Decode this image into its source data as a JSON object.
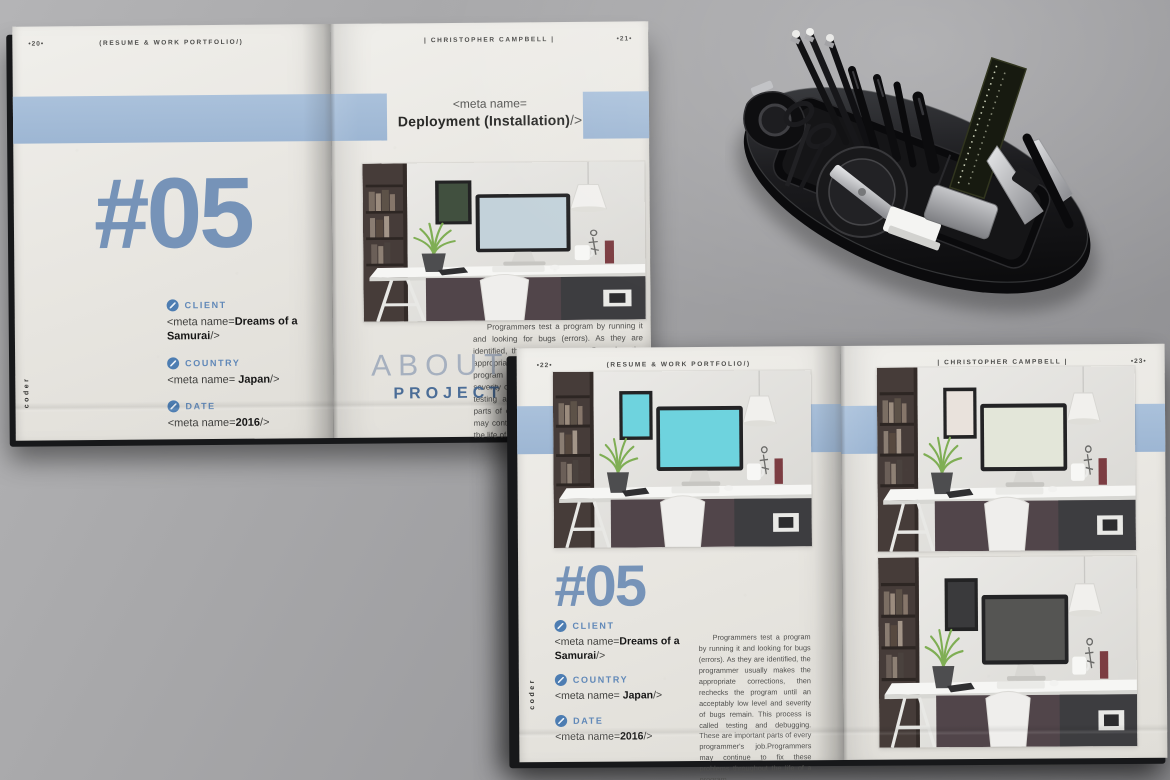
{
  "colors": {
    "background_gray": "#9a9a9d",
    "page": "#eceae5",
    "band_blue": "#a3bbd7",
    "number_blue": "#7693b8",
    "label_blue": "#6088b8",
    "title_blue": "#4b6d97",
    "teal_screen": "#6ed3de",
    "organizer_black": "#121214"
  },
  "top_spread": {
    "left_page": {
      "page_number": "•20•",
      "header": "(RESUME & WORK PORTFOLIO/)",
      "issue_number": "#05",
      "spine_text": "coder",
      "fields": [
        {
          "icon": "pencil-icon",
          "label": "CLIENT",
          "prefix": "<meta name=",
          "bold": "Dreams of a Samurai",
          "suffix": "/>"
        },
        {
          "icon": "globe-icon",
          "label": "COUNTRY",
          "prefix": "<meta name= ",
          "bold": "Japan",
          "suffix": "/>"
        },
        {
          "icon": "calendar-icon",
          "label": "DATE",
          "prefix": "<meta name=",
          "bold": "2016",
          "suffix": "/>"
        }
      ]
    },
    "right_page": {
      "header": "| CHRISTOPHER CAMPBELL |",
      "page_number": "•21•",
      "meta_line1": "<meta name=",
      "meta_line2_bold": "Deployment (Installation)",
      "meta_line2_suffix": "/>",
      "about_light": "ABOUT",
      "about_bold": "PROJECT",
      "paragraph": "Programmers test a program by running it and looking for bugs (errors). As they are identified, the programmer usually makes the appropriate corrections, then rechecks the program until an acceptably low level and severity of bugs remain. This process is called testing and debugging. These are important parts of every programmer's job.Programmers may continue to fix these problems throughout the life of a program"
    }
  },
  "bottom_spread": {
    "left_page": {
      "page_number": "•22•",
      "header": "(RESUME & WORK PORTFOLIO/)",
      "issue_number": "#05",
      "spine_text": "coder",
      "fields": [
        {
          "icon": "pencil-icon",
          "label": "CLIENT",
          "prefix": "<meta name=",
          "bold": "Dreams of a Samurai",
          "suffix": "/>"
        },
        {
          "icon": "globe-icon",
          "label": "COUNTRY",
          "prefix": "<meta name= ",
          "bold": "Japan",
          "suffix": "/>"
        },
        {
          "icon": "calendar-icon",
          "label": "DATE",
          "prefix": "<meta name=",
          "bold": "2016",
          "suffix": "/>"
        }
      ],
      "paragraph": "Programmers test a program by running it and looking for bugs (errors). As they are identified, the programmer usually makes the appropriate corrections, then rechecks the program until an acceptably low level and severity of bugs remain. This process is called testing and debugging. These are important parts of every programmer's job.Programmers may continue to fix these problems throughout the life of a program"
    },
    "right_page": {
      "header": "| CHRISTOPHER CAMPBELL |",
      "page_number": "•23•"
    }
  }
}
